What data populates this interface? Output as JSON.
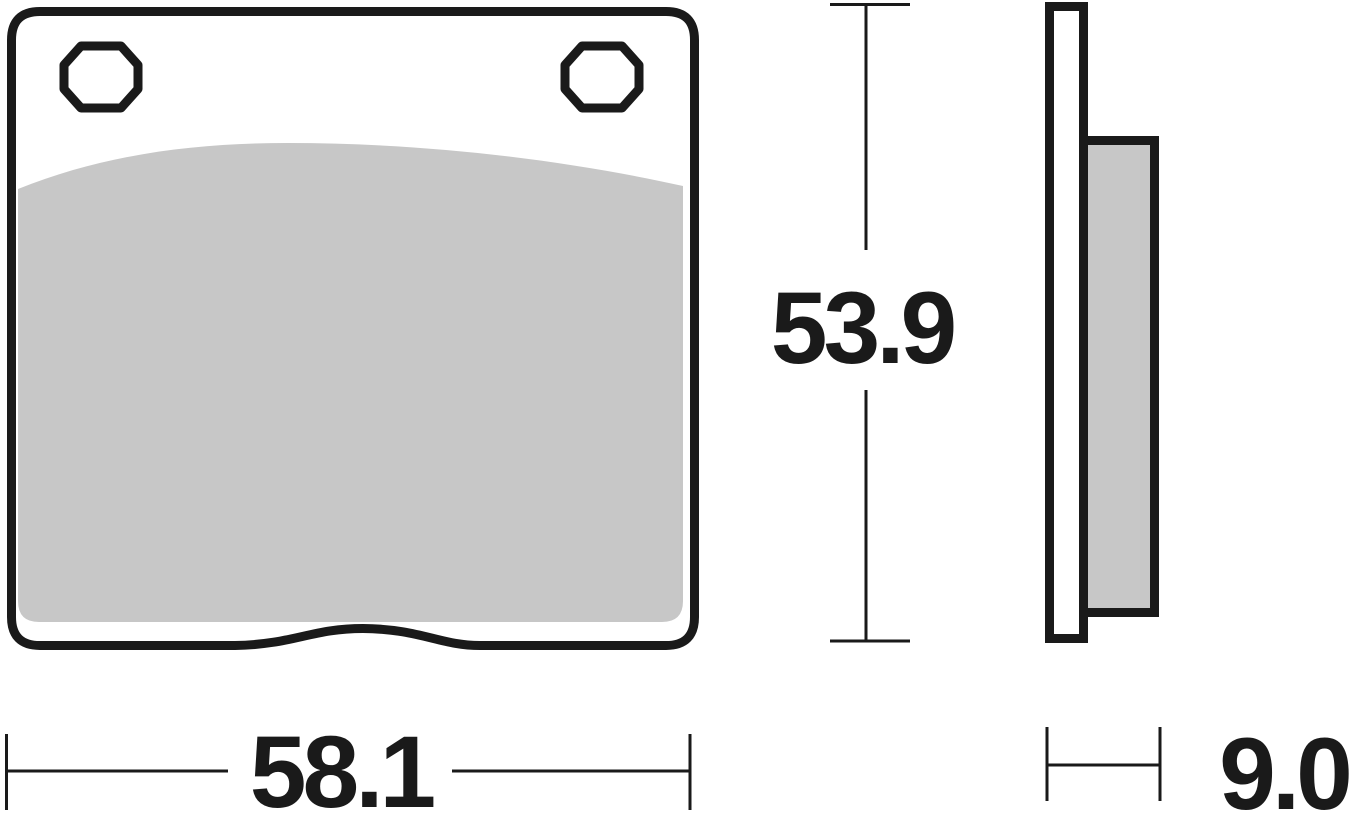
{
  "drawing": {
    "title": "Brake pad technical drawing",
    "views": [
      {
        "name": "front-view",
        "description": "Brake pad backplate with two mounting holes and friction material"
      },
      {
        "name": "side-view",
        "description": "Backplate and friction material thickness profile"
      }
    ]
  },
  "dimensions": {
    "width": "58.1",
    "height": "53.9",
    "thickness": "9.0"
  },
  "colors": {
    "ink": "#1a1a1a",
    "friction": "#c7c7c7",
    "background": "#ffffff"
  }
}
